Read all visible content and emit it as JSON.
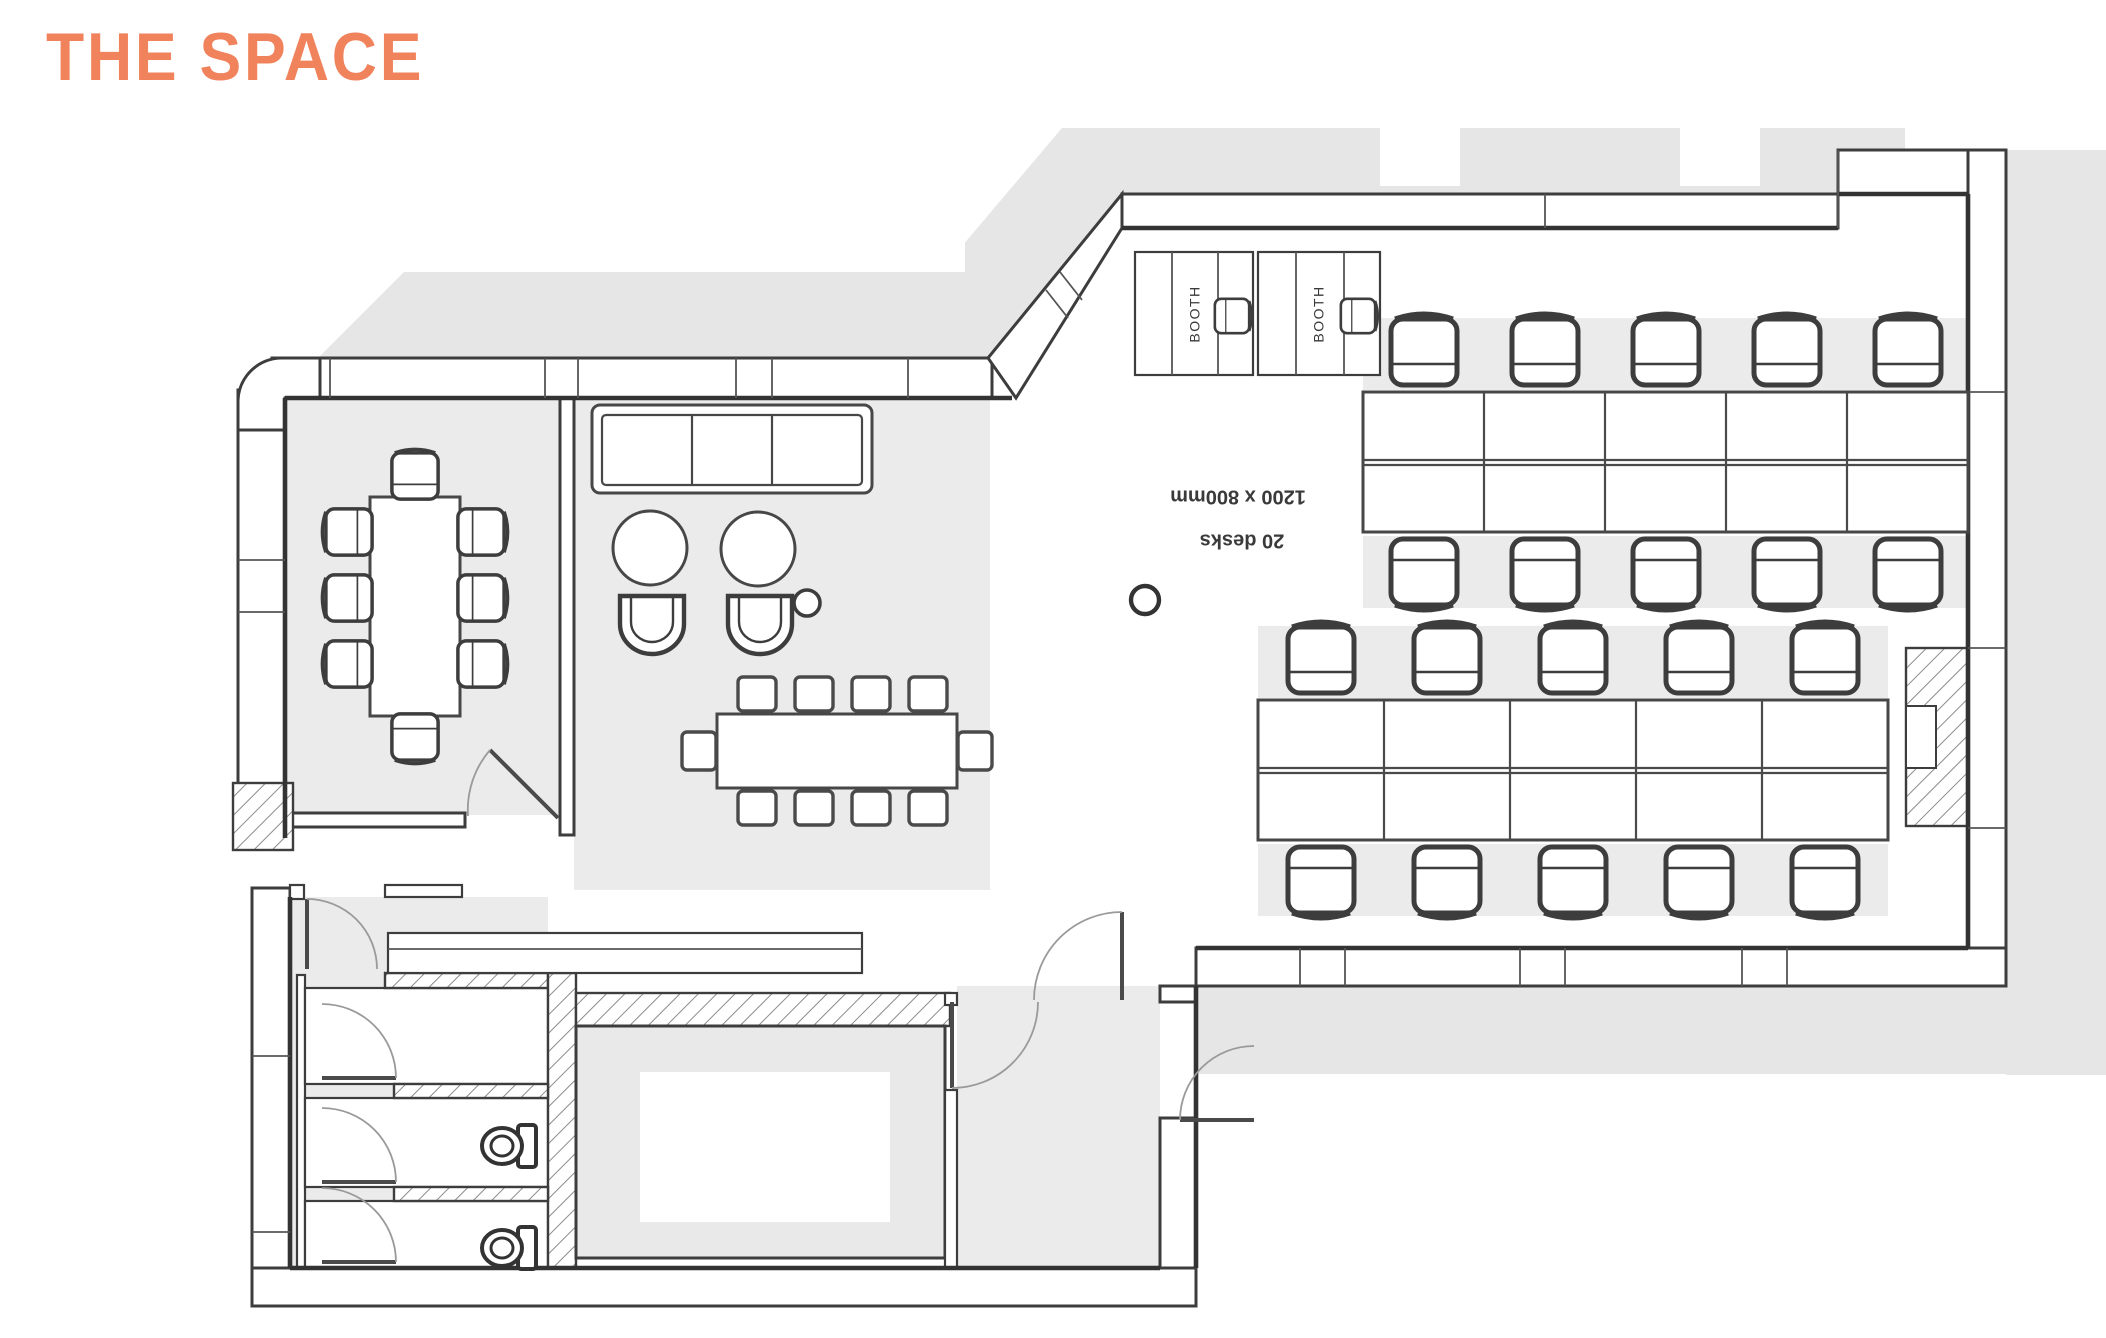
{
  "title": {
    "text": "THE SPACE",
    "color": "#F0825C"
  },
  "plan": {
    "booth_labels": [
      "BOOTH",
      "BOOTH"
    ],
    "desk_area_annotation": {
      "line1": "1200 x 800mm",
      "line2": "20 desks",
      "rotation_deg": 180
    },
    "colors": {
      "wall_line": "#3d3d3d",
      "floor_shade": "#ebebeb",
      "shadow": "#e6e6e6",
      "accent": "#F0825C"
    }
  }
}
